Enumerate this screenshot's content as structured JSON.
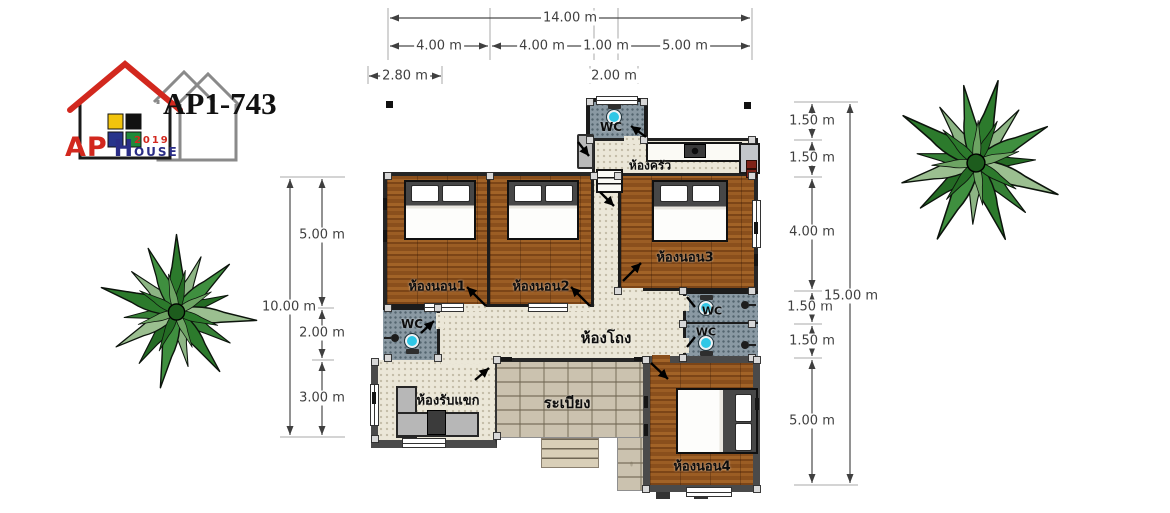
{
  "model": "AP1-743",
  "logo": {
    "ap": "AP",
    "house_initial": "H",
    "house_tail": "OUSE",
    "year": "2019"
  },
  "rooms": {
    "bedroom1": "ห้องนอน1",
    "bedroom2": "ห้องนอน2",
    "bedroom3": "ห้องนอน3",
    "bedroom4": "ห้องนอน4",
    "kitchen": "ห้องครัว",
    "hall": "ห้องโถง",
    "living_room": "ห้องรับแขก",
    "terrace": "ระเบียง",
    "wc": "WC"
  },
  "dimensions": {
    "top": {
      "total": "14.00 m",
      "segments": [
        "4.00 m",
        "4.00 m",
        "1.00 m",
        "5.00 m"
      ],
      "offsets": [
        "2.80 m",
        "2.00 m"
      ]
    },
    "right": {
      "total": "15.00 m",
      "segments": [
        "1.50 m",
        "1.50 m",
        "4.00 m",
        "1.50 m",
        "1.50 m",
        "5.00 m"
      ]
    },
    "left": {
      "total": "10.00 m",
      "segments": [
        "5.00 m",
        "2.00 m",
        "3.00 m"
      ]
    }
  },
  "colors": {
    "wood_floor": "#8f5520",
    "tile_cream": "#ebe7d8",
    "wc_floor": "#8a99a3",
    "terrace_stone": "#cbc2af",
    "wall_dark": "#262626",
    "brand_red": "#d2281e",
    "brand_blue": "#2a2d86",
    "toilet_cyan": "#2fc7e6",
    "tree_green": "#2c7a2c"
  }
}
